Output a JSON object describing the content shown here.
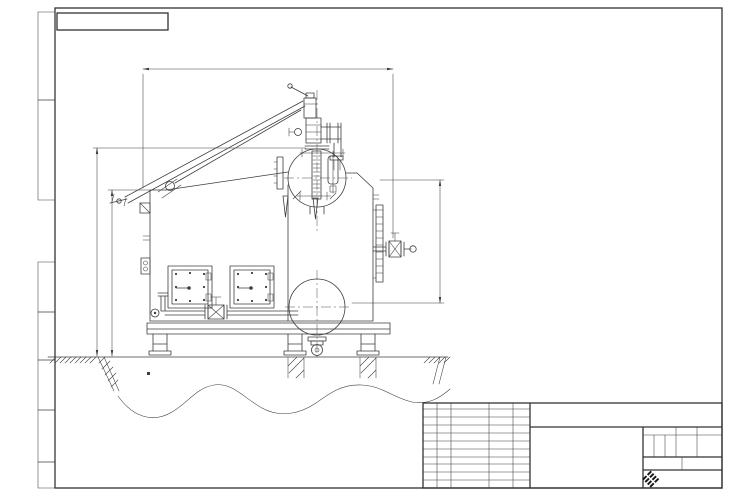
{
  "watermark": {
    "text": "KVZR.RU"
  },
  "corner_stamp": {
    "designation": "ЕТД.10.031.00.000  ВО"
  },
  "side_strip": {
    "labels": [
      "Перв. примен.",
      "Справ. №",
      "Подп. и дата",
      "Инв. № дубл.",
      "Взам. инв. №",
      "Подп. и дата",
      "Инв. № подл."
    ]
  },
  "dimensions": {
    "width": "3040*",
    "height_total": "3200*",
    "height_furnace": "2604",
    "height_right": "1500"
  },
  "annotations": {
    "see_note": "См. п. 2"
  },
  "notes": {
    "items": [
      "1.   * Размеры уточняются на монтаже.",
      "2.   Бункер-шлаконакопитель или канал шлакоудаления."
    ]
  },
  "title_block": {
    "designation": "ЕТД.10.031.00.000  В0",
    "product_name": "Котел паровой",
    "product_type": "Е-1,0-0,9-170",
    "header": {
      "izm": "Изм",
      "list": "Лист",
      "doc": "N докум.",
      "sign": "Подп.",
      "date": "Дата"
    },
    "rows": [
      "Разраб.",
      "Пров.",
      "Т.контр",
      "Н.контр",
      "Утв."
    ],
    "lit_label": "Лит",
    "mass_label": "Масса",
    "scale_label": "Масштаб",
    "lit_value": "И",
    "scale_value": "1:20",
    "sheet": "Лист 1",
    "sheets": "Листов 2",
    "logo": {
      "text": "KVZR",
      "sub1": "КОТЕЛЬНЫЙ",
      "sub2": "ЗАВОД РЭП"
    },
    "format": "Формат А3"
  }
}
